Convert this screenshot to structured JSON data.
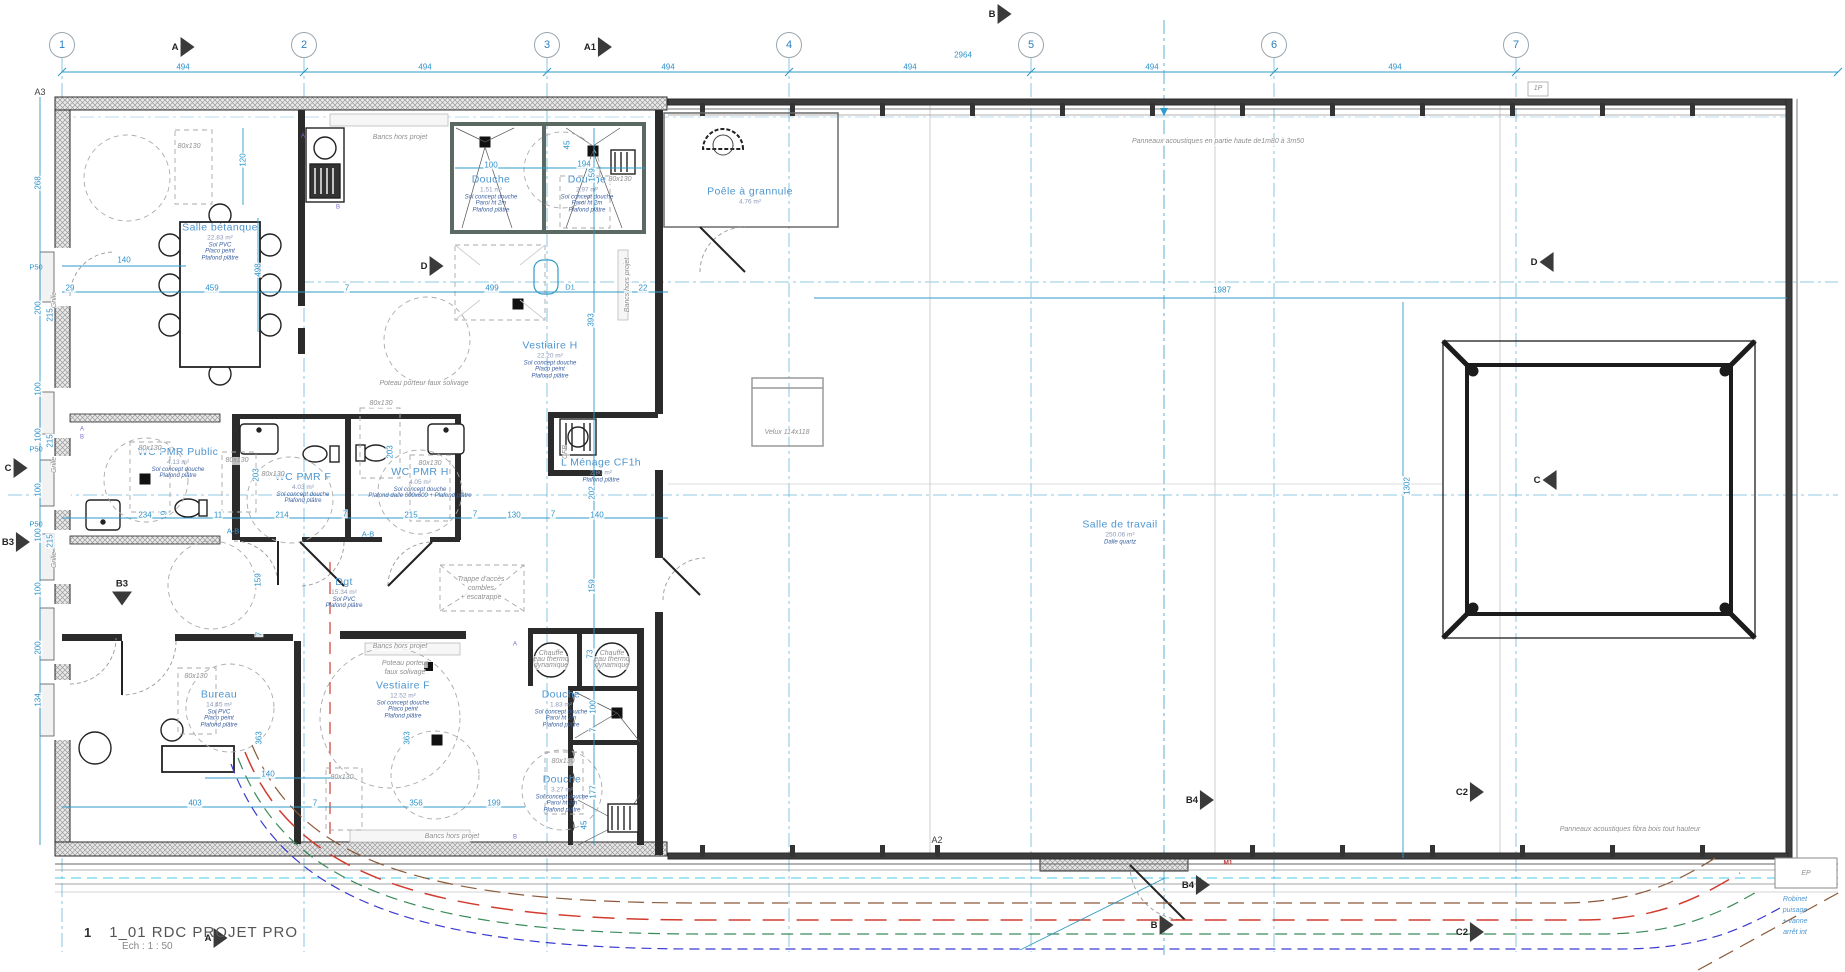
{
  "titleBlock": {
    "number": "1",
    "title": "1_01 RDC PROJET PRO",
    "scale": "Ech :  1 : 50",
    "marker": "A"
  },
  "colors": {
    "dimBlue": "#2d93cc",
    "roomBlue": "#4f96cf",
    "noteBlue": "#3a5fa0",
    "annGray": "#8f8f8f",
    "wall": "#2b2b2b",
    "cyan": "#49c8e8",
    "red": "#d23b2f",
    "green": "#3a8a5a",
    "brown": "#8a5a3a",
    "navy": "#3a3ad0"
  },
  "gridBubbles": [
    {
      "label": "1",
      "x": 62
    },
    {
      "label": "2",
      "x": 304
    },
    {
      "label": "3",
      "x": 547
    },
    {
      "label": "4",
      "x": 789
    },
    {
      "label": "5",
      "x": 1031
    },
    {
      "label": "6",
      "x": 1274
    },
    {
      "label": "7",
      "x": 1516
    }
  ],
  "sectionMarkers": [
    {
      "l": "A",
      "x": 183,
      "y": 47,
      "d": "r"
    },
    {
      "l": "A1",
      "x": 598,
      "y": 47,
      "d": "r"
    },
    {
      "l": "B",
      "x": 1000,
      "y": 14,
      "d": "r"
    },
    {
      "l": "D",
      "x": 432,
      "y": 266,
      "d": "r"
    },
    {
      "l": "D",
      "x": 1542,
      "y": 262,
      "d": "l"
    },
    {
      "l": "C",
      "x": 16,
      "y": 468,
      "d": "r"
    },
    {
      "l": "C",
      "x": 1545,
      "y": 480,
      "d": "l"
    },
    {
      "l": "B3",
      "x": 16,
      "y": 542,
      "d": "r"
    },
    {
      "l": "B3",
      "x": 122,
      "y": 592,
      "d": "d"
    },
    {
      "l": "B4",
      "x": 1200,
      "y": 800,
      "d": "r"
    },
    {
      "l": "B4",
      "x": 1196,
      "y": 885,
      "d": "r"
    },
    {
      "l": "B",
      "x": 1162,
      "y": 925,
      "d": "r"
    },
    {
      "l": "C2",
      "x": 1470,
      "y": 792,
      "d": "r"
    },
    {
      "l": "C2",
      "x": 1470,
      "y": 932,
      "d": "r"
    },
    {
      "l": "A",
      "x": 216,
      "y": 938,
      "d": "r"
    }
  ],
  "rooms": [
    {
      "name": "Salle bétanque",
      "area": "22.83 m²",
      "notes": [
        "Sol PVC",
        "Placo peint",
        "Plafond plâtre"
      ],
      "x": 220,
      "y": 232
    },
    {
      "name": "Douche",
      "area": "1.51 m²",
      "notes": [
        "Sol concept douche",
        "Paroi ht 2m",
        "Plafond plâtre"
      ],
      "x": 491,
      "y": 184
    },
    {
      "name": "Douche",
      "area": "2.97 m²",
      "notes": [
        "Sol concept douche",
        "Paroi ht 2m",
        "Plafond plâtre"
      ],
      "x": 587,
      "y": 184
    },
    {
      "name": "Vestiaire H",
      "area": "22.20 m²",
      "notes": [
        "Sol concept douche",
        "Placo peint",
        "Plafond plâtre"
      ],
      "x": 550,
      "y": 350
    },
    {
      "name": "L Ménage CF1h",
      "area": "2.80 m²",
      "notes": [
        "Plafond plâtre"
      ],
      "x": 601,
      "y": 460
    },
    {
      "name": "WC PMR Public",
      "area": "4.13 m²",
      "notes": [
        "Sol concept douche",
        "Plafond plâtre"
      ],
      "x": 178,
      "y": 453
    },
    {
      "name": "WC PMR F",
      "area": "4.03 m²",
      "notes": [
        "Sol concept douche",
        "Plafond plâtre"
      ],
      "x": 303,
      "y": 478
    },
    {
      "name": "WC PMR H",
      "area": "4.05 m²",
      "notes": [
        "Sol concept douche",
        "Plafond dalle 600x600 + Plafond plâtre"
      ],
      "x": 420,
      "y": 473
    },
    {
      "name": "Dgt",
      "area": "15.34 m²",
      "notes": [
        "Sol PVC",
        "Plafond plâtre"
      ],
      "x": 344,
      "y": 583
    },
    {
      "name": "Bureau",
      "area": "14.45 m²",
      "notes": [
        "Sol PVC",
        "Placo peint",
        "Plafond plâtre"
      ],
      "x": 219,
      "y": 699
    },
    {
      "name": "Vestiaire F",
      "area": "12.52 m²",
      "notes": [
        "Sol concept douche",
        "Placo peint",
        "Plafond plâtre"
      ],
      "x": 403,
      "y": 690
    },
    {
      "name": "Douche",
      "area": "1.83 m²",
      "notes": [
        "Sol concept douche",
        "Paroi ht 2m",
        "Plafond plâtre"
      ],
      "x": 561,
      "y": 699
    },
    {
      "name": "Douche",
      "area": "3.27 m²",
      "notes": [
        "Sol concept douche",
        "Paroi ht 2m",
        "Plafond plâtre"
      ],
      "x": 562,
      "y": 784
    },
    {
      "name": "Salle de travail",
      "area": "250.06 m²",
      "notes": [
        "Dalle quartz"
      ],
      "x": 1120,
      "y": 522
    },
    {
      "name": "Poêle à grannule",
      "area": "4.76 m²",
      "notes": [],
      "x": 750,
      "y": 186
    }
  ],
  "dims": [
    {
      "t": "494",
      "x": 183,
      "y": 67
    },
    {
      "t": "494",
      "x": 425,
      "y": 67
    },
    {
      "t": "494",
      "x": 668,
      "y": 67
    },
    {
      "t": "494",
      "x": 910,
      "y": 67
    },
    {
      "t": "494",
      "x": 1152,
      "y": 67
    },
    {
      "t": "494",
      "x": 1395,
      "y": 67
    },
    {
      "t": "2964",
      "x": 963,
      "y": 55
    },
    {
      "t": "140",
      "x": 124,
      "y": 260
    },
    {
      "t": "120",
      "x": 243,
      "y": 160,
      "r": 1
    },
    {
      "t": "498",
      "x": 258,
      "y": 270,
      "r": 1
    },
    {
      "t": "29",
      "x": 70,
      "y": 288
    },
    {
      "t": "459",
      "x": 212,
      "y": 288
    },
    {
      "t": "7",
      "x": 347,
      "y": 288
    },
    {
      "t": "499",
      "x": 492,
      "y": 288
    },
    {
      "t": "22",
      "x": 643,
      "y": 288
    },
    {
      "t": "100",
      "x": 491,
      "y": 165
    },
    {
      "t": "194",
      "x": 584,
      "y": 164
    },
    {
      "t": "45",
      "x": 567,
      "y": 145,
      "r": 1
    },
    {
      "t": "159",
      "x": 592,
      "y": 175,
      "r": 1
    },
    {
      "t": "393",
      "x": 591,
      "y": 320,
      "r": 1
    },
    {
      "t": "203",
      "x": 256,
      "y": 475,
      "r": 1
    },
    {
      "t": "203",
      "x": 390,
      "y": 452,
      "r": 1
    },
    {
      "t": "202",
      "x": 592,
      "y": 493,
      "r": 1
    },
    {
      "t": "234",
      "x": 145,
      "y": 515
    },
    {
      "t": "9",
      "x": 164,
      "y": 513,
      "r": 1
    },
    {
      "t": "11",
      "x": 218,
      "y": 515
    },
    {
      "t": "214",
      "x": 282,
      "y": 515
    },
    {
      "t": "7",
      "x": 345,
      "y": 514
    },
    {
      "t": "215",
      "x": 411,
      "y": 515
    },
    {
      "t": "7",
      "x": 475,
      "y": 514
    },
    {
      "t": "130",
      "x": 514,
      "y": 515
    },
    {
      "t": "7",
      "x": 553,
      "y": 514
    },
    {
      "t": "140",
      "x": 597,
      "y": 515
    },
    {
      "t": "159",
      "x": 258,
      "y": 580,
      "r": 1
    },
    {
      "t": "159",
      "x": 592,
      "y": 586,
      "r": 1
    },
    {
      "t": "7",
      "x": 259,
      "y": 634,
      "r": 1
    },
    {
      "t": "363",
      "x": 259,
      "y": 738,
      "r": 1
    },
    {
      "t": "363",
      "x": 407,
      "y": 738,
      "r": 1
    },
    {
      "t": "73",
      "x": 590,
      "y": 654,
      "r": 1
    },
    {
      "t": "100",
      "x": 593,
      "y": 707,
      "r": 1
    },
    {
      "t": "7",
      "x": 593,
      "y": 730,
      "r": 1
    },
    {
      "t": "177",
      "x": 593,
      "y": 792,
      "r": 1
    },
    {
      "t": "45",
      "x": 584,
      "y": 825,
      "r": 1
    },
    {
      "t": "356",
      "x": 416,
      "y": 803
    },
    {
      "t": "199",
      "x": 494,
      "y": 803
    },
    {
      "t": "403",
      "x": 195,
      "y": 803
    },
    {
      "t": "140",
      "x": 268,
      "y": 774
    },
    {
      "t": "7",
      "x": 315,
      "y": 803
    },
    {
      "t": "1987",
      "x": 1222,
      "y": 290
    },
    {
      "t": "1302",
      "x": 1407,
      "y": 486,
      "r": 1
    },
    {
      "t": "268",
      "x": 38,
      "y": 183,
      "r": 1
    },
    {
      "t": "200",
      "x": 38,
      "y": 308,
      "r": 1
    },
    {
      "t": "215",
      "x": 50,
      "y": 315,
      "r": 1
    },
    {
      "t": "100",
      "x": 38,
      "y": 389,
      "r": 1
    },
    {
      "t": "100",
      "x": 38,
      "y": 435,
      "r": 1
    },
    {
      "t": "215",
      "x": 50,
      "y": 441,
      "r": 1
    },
    {
      "t": "100",
      "x": 38,
      "y": 490,
      "r": 1
    },
    {
      "t": "100",
      "x": 38,
      "y": 535,
      "r": 1
    },
    {
      "t": "215",
      "x": 50,
      "y": 541,
      "r": 1
    },
    {
      "t": "100",
      "x": 38,
      "y": 589,
      "r": 1
    },
    {
      "t": "200",
      "x": 38,
      "y": 648,
      "r": 1
    },
    {
      "t": "134",
      "x": 38,
      "y": 700,
      "r": 1
    }
  ],
  "annotations": [
    {
      "t": "Panneaux acoustiques en partie haute de1m80 à 3m50",
      "x": 1218,
      "y": 142,
      "c": "g"
    },
    {
      "t": "Panneaux acoustiques fibra bois tout hauteur",
      "x": 1630,
      "y": 830,
      "c": "g"
    },
    {
      "t": "Poteau porteur faux solivage",
      "x": 424,
      "y": 384,
      "c": "g"
    },
    {
      "t": "Poteau porteur",
      "x": 405,
      "y": 664,
      "c": "g"
    },
    {
      "t": "faux solivage",
      "x": 405,
      "y": 673,
      "c": "g"
    },
    {
      "t": "Bancs hors projet",
      "x": 400,
      "y": 138,
      "c": "g"
    },
    {
      "t": "Bancs hors projet",
      "x": 400,
      "y": 647,
      "c": "g"
    },
    {
      "t": "Bancs hors projet",
      "x": 452,
      "y": 837,
      "c": "g"
    },
    {
      "t": "Bancs hors projet",
      "x": 628,
      "y": 285,
      "c": "g",
      "r": 1
    },
    {
      "t": "Trappe d'accès",
      "x": 481,
      "y": 580,
      "c": "g"
    },
    {
      "t": "combles",
      "x": 481,
      "y": 589,
      "c": "g"
    },
    {
      "t": "+ escatrappe",
      "x": 481,
      "y": 598,
      "c": "g"
    },
    {
      "t": "Velux 114x118",
      "x": 787,
      "y": 433,
      "c": "g"
    },
    {
      "t": "Chauffe",
      "x": 551,
      "y": 654,
      "c": "g"
    },
    {
      "t": "eau thermo",
      "x": 551,
      "y": 660,
      "c": "g"
    },
    {
      "t": "dynamique",
      "x": 551,
      "y": 666,
      "c": "g"
    },
    {
      "t": "Chauffe",
      "x": 612,
      "y": 654,
      "c": "g"
    },
    {
      "t": "eau thermo",
      "x": 612,
      "y": 660,
      "c": "g"
    },
    {
      "t": "dynamique",
      "x": 612,
      "y": 666,
      "c": "g"
    },
    {
      "t": "Robinet",
      "x": 1795,
      "y": 900,
      "c": "b"
    },
    {
      "t": "puisage",
      "x": 1795,
      "y": 911,
      "c": "b"
    },
    {
      "t": "+ vanne",
      "x": 1795,
      "y": 922,
      "c": "b"
    },
    {
      "t": "arrêt int",
      "x": 1795,
      "y": 933,
      "c": "b"
    },
    {
      "t": "A3",
      "x": 40,
      "y": 92,
      "c": "d"
    },
    {
      "t": "A2",
      "x": 937,
      "y": 840,
      "c": "d"
    },
    {
      "t": "D1",
      "x": 570,
      "y": 288,
      "c": "b2"
    },
    {
      "t": "M1",
      "x": 1228,
      "y": 863,
      "c": "r"
    },
    {
      "t": "EP",
      "x": 1806,
      "y": 874,
      "c": "g"
    },
    {
      "t": "1P",
      "x": 1538,
      "y": 89,
      "c": "g"
    },
    {
      "t": "Grille",
      "x": 55,
      "y": 300,
      "c": "g",
      "r": 1
    },
    {
      "t": "Grille",
      "x": 55,
      "y": 465,
      "c": "g",
      "r": 1
    },
    {
      "t": "Grille",
      "x": 55,
      "y": 560,
      "c": "g",
      "r": 1
    },
    {
      "t": "P50",
      "x": 36,
      "y": 268,
      "c": "b2"
    },
    {
      "t": "P50",
      "x": 36,
      "y": 450,
      "c": "b2"
    },
    {
      "t": "P50",
      "x": 36,
      "y": 525,
      "c": "b2"
    },
    {
      "t": "80x130",
      "x": 189,
      "y": 147,
      "c": "g"
    },
    {
      "t": "80x130",
      "x": 620,
      "y": 180,
      "c": "g"
    },
    {
      "t": "80x130",
      "x": 381,
      "y": 404,
      "c": "g"
    },
    {
      "t": "80x130",
      "x": 150,
      "y": 449,
      "c": "g"
    },
    {
      "t": "80x130",
      "x": 237,
      "y": 461,
      "c": "g"
    },
    {
      "t": "80x130",
      "x": 273,
      "y": 475,
      "c": "g"
    },
    {
      "t": "80x130",
      "x": 430,
      "y": 464,
      "c": "g"
    },
    {
      "t": "80x130",
      "x": 196,
      "y": 677,
      "c": "g"
    },
    {
      "t": "80x130",
      "x": 342,
      "y": 778,
      "c": "g"
    },
    {
      "t": "80x130",
      "x": 563,
      "y": 762,
      "c": "g"
    },
    {
      "t": "A-B",
      "x": 233,
      "y": 532,
      "c": "b2"
    },
    {
      "t": "A-B",
      "x": 368,
      "y": 535,
      "c": "b2"
    },
    {
      "t": "A",
      "x": 303,
      "y": 137,
      "c": "v"
    },
    {
      "t": "B",
      "x": 338,
      "y": 208,
      "c": "v"
    },
    {
      "t": "A",
      "x": 82,
      "y": 430,
      "c": "v"
    },
    {
      "t": "B",
      "x": 82,
      "y": 438,
      "c": "v"
    },
    {
      "t": "A",
      "x": 515,
      "y": 645,
      "c": "v"
    },
    {
      "t": "B",
      "x": 515,
      "y": 838,
      "c": "v"
    },
    {
      "t": "CFB",
      "x": 566,
      "y": 452,
      "c": "g",
      "r": 1
    }
  ]
}
